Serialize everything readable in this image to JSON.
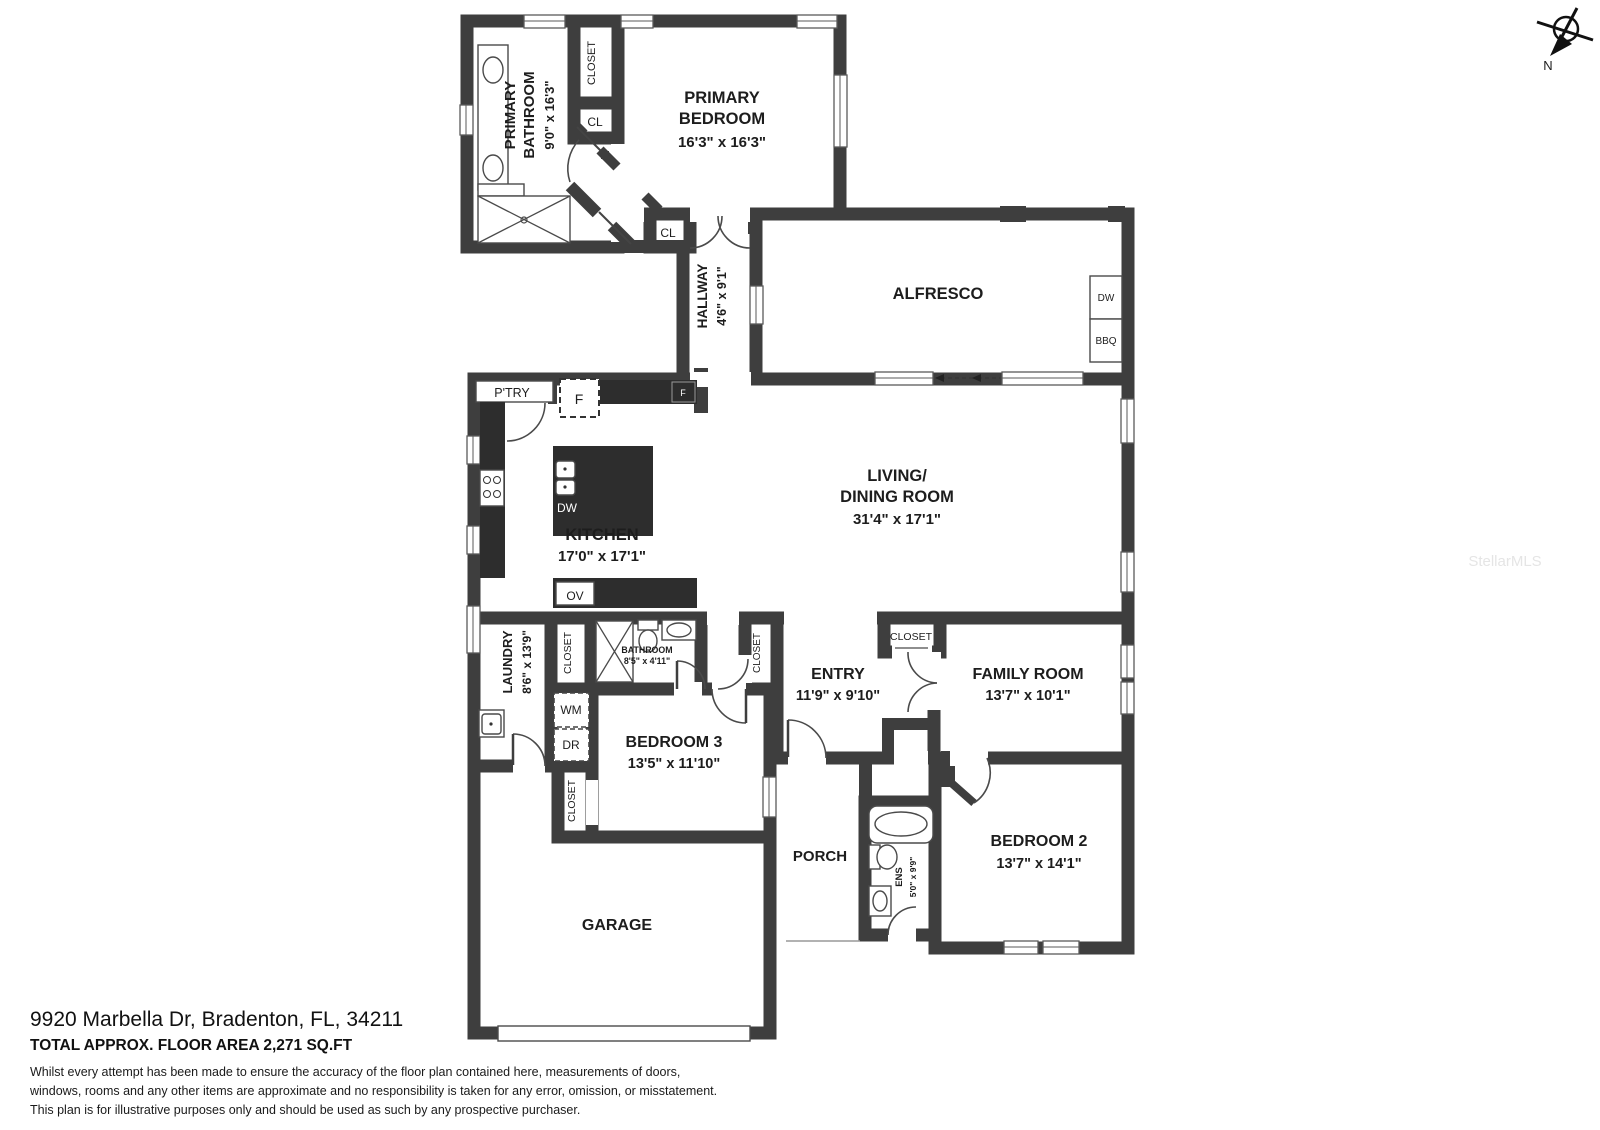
{
  "page": {
    "wall_color": "#3e3e3e",
    "background": "#ffffff"
  },
  "compass": {
    "label": "N"
  },
  "watermark": "StellarMLS",
  "rooms": {
    "primary_bathroom": {
      "name1": "PRIMARY",
      "name2": "BATHROOM",
      "dims": "9'0\" x 16'3\""
    },
    "primary_bedroom": {
      "name1": "PRIMARY",
      "name2": "BEDROOM",
      "dims": "16'3\" x 16'3\""
    },
    "hallway": {
      "name": "HALLWAY",
      "dims": "4'6\" x 9'1\""
    },
    "alfresco": {
      "name": "ALFRESCO"
    },
    "kitchen": {
      "name": "KITCHEN",
      "dims": "17'0\" x 17'1\""
    },
    "living": {
      "name1": "LIVING/",
      "name2": "DINING ROOM",
      "dims": "31'4\" x 17'1\""
    },
    "laundry": {
      "name": "LAUNDRY",
      "dims": "8'6\" x 13'9\""
    },
    "bathroom": {
      "name": "BATHROOM",
      "dims": "8'5\" x 4'11\""
    },
    "bedroom3": {
      "name": "BEDROOM 3",
      "dims": "13'5\" x 11'10\""
    },
    "entry": {
      "name": "ENTRY",
      "dims": "11'9\" x 9'10\""
    },
    "family": {
      "name": "FAMILY ROOM",
      "dims": "13'7\" x 10'1\""
    },
    "bedroom2": {
      "name": "BEDROOM 2",
      "dims": "13'7\" x 14'1\""
    },
    "ens": {
      "name": "ENS",
      "dims": "5'0\" x 9'9\""
    },
    "porch": {
      "name": "PORCH"
    },
    "garage": {
      "name": "GARAGE"
    }
  },
  "labels": {
    "closet_primary": "CLOSET",
    "closet_laundry": "CLOSET",
    "closet_bed3": "CLOSET",
    "closet_entry": "CLOSET",
    "closet_family": "CLOSET",
    "cl_bath": "CL",
    "cl_hall": "CL",
    "pantry": "P'TRY",
    "fridge": "F",
    "fridge_small": "F",
    "dw_island": "DW",
    "oven": "OV",
    "washer": "WM",
    "dryer": "DR",
    "dw_alfresco": "DW",
    "bbq": "BBQ"
  },
  "footer": {
    "address": "9920 Marbella Dr, Bradenton, FL, 34211",
    "area": "TOTAL APPROX. FLOOR AREA 2,271 SQ.FT",
    "disclaimer": [
      "Whilst every attempt has been made to ensure the accuracy of the floor plan contained here, measurements of doors,",
      "windows, rooms and any other items are approximate and no responsibility is taken for any error, omission, or misstatement.",
      "This plan is for illustrative purposes only and should be used as such by any prospective purchaser."
    ]
  }
}
